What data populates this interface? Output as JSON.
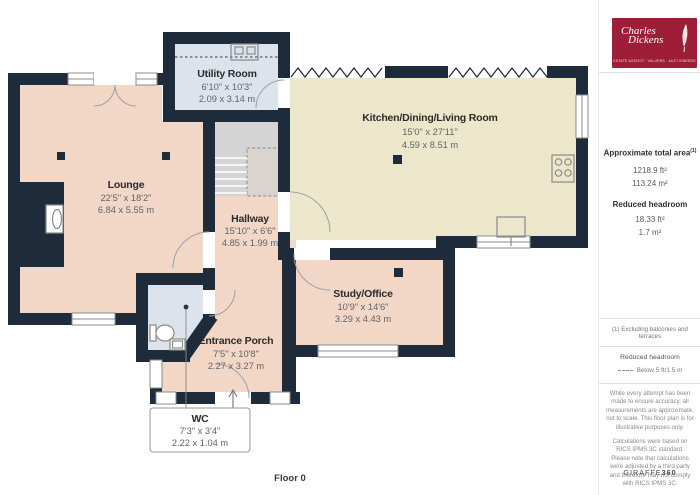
{
  "colors": {
    "wall": "#1e2b3a",
    "floor_pink": "#f2d6c6",
    "floor_cream": "#ece7ca",
    "floor_blue": "#dde3ec",
    "stairs_gray": "#d4d4d4",
    "logo_red": "#9e1e38"
  },
  "plan": {
    "floor_label": "Floor 0",
    "rooms": [
      {
        "name": "Utility Room",
        "dims_ft": "6'10\" x 10'3\"",
        "dims_m": "2.09 x 3.14 m"
      },
      {
        "name": "Kitchen/Dining/Living Room",
        "dims_ft": "15'0\" x 27'11\"",
        "dims_m": "4.59 x 8.51 m"
      },
      {
        "name": "Lounge",
        "dims_ft": "22'5\" x 18'2\"",
        "dims_m": "6.84 x 5.55 m"
      },
      {
        "name": "Hallway",
        "dims_ft": "15'10\" x 6'6\"",
        "dims_m": "4.85 x 1.99 m"
      },
      {
        "name": "Study/Office",
        "dims_ft": "10'9\" x 14'6\"",
        "dims_m": "3.29 x 4.43 m"
      },
      {
        "name": "Entrance Porch",
        "dims_ft": "7'5\" x 10'8\"",
        "dims_m": "2.27 x 3.27 m"
      },
      {
        "name": "WC",
        "dims_ft": "7'3\" x 3'4\"",
        "dims_m": "2.22 x 1.04 m"
      }
    ]
  },
  "sidebar": {
    "logo": {
      "name_line1": "Charles",
      "name_line2": "Dickens",
      "tagline": "ESTATE AGENTS · VALUERS · AUCTIONEERS"
    },
    "area": {
      "title": "Approximate total area",
      "title_sup": "(1)",
      "total_ft": "1218.9 ft²",
      "total_m": "113.24 m²",
      "reduced_title": "Reduced headroom",
      "reduced_ft": "18.33 ft²",
      "reduced_m": "1.7 m²"
    },
    "note": "(1) Excluding balconies and terraces",
    "legend": {
      "title": "Reduced headroom",
      "label": "Below 5 ft/1.5 m"
    },
    "disclaimer1": "While every attempt has been made to ensure accuracy, all measurements are approximate, not to scale. This floor plan is for illustrative purposes only.",
    "disclaimer2": "Calculations were based on RICS IPMS 3C standard. Please note that calculations were adjusted by a third party and therefore may not comply with RICS IPMS 3C.",
    "brand": {
      "name": "GIRAFFE",
      "suffix": "360"
    }
  }
}
